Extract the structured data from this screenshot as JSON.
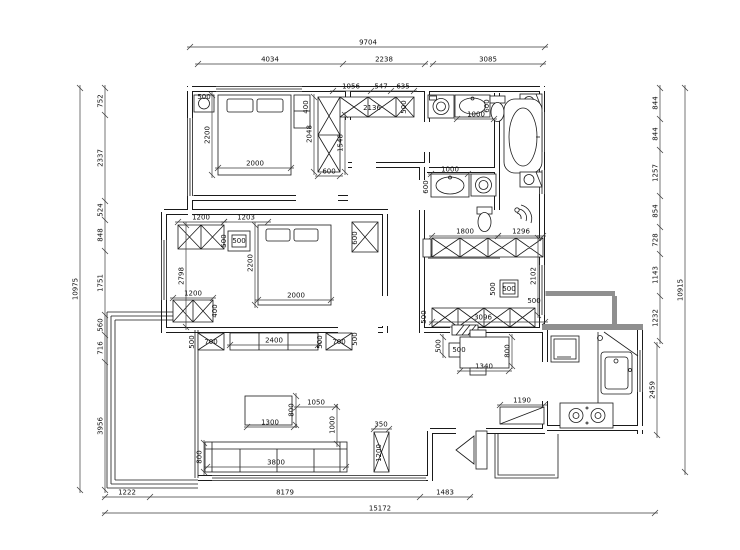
{
  "drawing": {
    "type": "apartment-floor-plan",
    "units": "mm"
  },
  "colors": {
    "line": "#1a1a1a",
    "gray_wall": "#8f8f8f",
    "background": "#ffffff",
    "dim_text": "#101010"
  },
  "dimensions": {
    "chains": [
      {
        "o": "h",
        "p": 47,
        "a": 190,
        "b": 545,
        "labels": [
          {
            "t": "9704",
            "at": 368
          }
        ]
      },
      {
        "o": "h",
        "p": 64,
        "a": 198,
        "b": 425,
        "ticks": [
          198,
          343,
          425
        ],
        "labels": [
          {
            "t": "4034",
            "at": 270
          },
          {
            "t": "2238",
            "at": 384
          }
        ]
      },
      {
        "o": "h",
        "p": 64,
        "a": 433,
        "b": 543,
        "labels": [
          {
            "t": "3085",
            "at": 488
          }
        ]
      },
      {
        "o": "h",
        "p": 91,
        "a": 333,
        "b": 414,
        "ticks": [
          333,
          371,
          391,
          414
        ],
        "labels": [
          {
            "t": "1056",
            "at": 351
          },
          {
            "t": "547",
            "at": 381
          },
          {
            "t": "635",
            "at": 403
          }
        ]
      },
      {
        "o": "v",
        "p": 80,
        "a": 88,
        "b": 490,
        "labels": [
          {
            "t": "10975",
            "at": 289
          }
        ]
      },
      {
        "o": "v",
        "p": 105,
        "a": 88,
        "b": 490,
        "ticks": [
          88,
          115,
          201,
          220,
          251,
          315,
          335,
          362,
          490
        ],
        "labels": [
          {
            "t": "752",
            "at": 101
          },
          {
            "t": "2337",
            "at": 158
          },
          {
            "t": "524",
            "at": 210
          },
          {
            "t": "848",
            "at": 235
          },
          {
            "t": "1751",
            "at": 283
          },
          {
            "t": "560",
            "at": 325
          },
          {
            "t": "716",
            "at": 348
          },
          {
            "t": "3956",
            "at": 426
          }
        ]
      },
      {
        "o": "v",
        "p": 660,
        "a": 88,
        "b": 341,
        "ticks": [
          88,
          119,
          150,
          196,
          227,
          254,
          296,
          341
        ],
        "labels": [
          {
            "t": "844",
            "at": 103
          },
          {
            "t": "844",
            "at": 134
          },
          {
            "t": "1257",
            "at": 173
          },
          {
            "t": "854",
            "at": 211
          },
          {
            "t": "728",
            "at": 240
          },
          {
            "t": "1143",
            "at": 275
          },
          {
            "t": "1232",
            "at": 318
          }
        ]
      },
      {
        "o": "v",
        "p": 657,
        "a": 345,
        "b": 435,
        "labels": [
          {
            "t": "2459",
            "at": 390
          }
        ]
      },
      {
        "o": "v",
        "p": 685,
        "a": 88,
        "b": 472,
        "labels": [
          {
            "t": "10915",
            "at": 290
          }
        ]
      },
      {
        "o": "h",
        "p": 497,
        "a": 105,
        "b": 470,
        "ticks": [
          105,
          150,
          420,
          470
        ],
        "labels": [
          {
            "t": "1222",
            "at": 127
          },
          {
            "t": "8179",
            "at": 285
          },
          {
            "t": "1483",
            "at": 445
          }
        ]
      },
      {
        "o": "h",
        "p": 513,
        "a": 105,
        "b": 655,
        "labels": [
          {
            "t": "15172",
            "at": 380
          }
        ]
      },
      {
        "o": "h",
        "p": 168,
        "a": 218,
        "b": 291,
        "labels": [
          {
            "t": "2000",
            "at": 255
          }
        ]
      },
      {
        "o": "v",
        "p": 212,
        "a": 95,
        "b": 175,
        "labels": [
          {
            "t": "2200",
            "at": 135
          }
        ]
      },
      {
        "o": "h",
        "p": 119,
        "a": 457,
        "b": 494,
        "labels": [
          {
            "t": "1000",
            "at": 476
          }
        ]
      },
      {
        "o": "h",
        "p": 174,
        "a": 431,
        "b": 468,
        "labels": [
          {
            "t": "1000",
            "at": 450
          }
        ]
      },
      {
        "o": "h",
        "p": 236,
        "a": 432,
        "b": 498,
        "labels": [
          {
            "t": "1800",
            "at": 465
          }
        ]
      },
      {
        "o": "h",
        "p": 236,
        "a": 498,
        "b": 543,
        "labels": [
          {
            "t": "1296",
            "at": 521
          }
        ]
      },
      {
        "o": "v",
        "p": 538,
        "a": 238,
        "b": 315,
        "labels": [
          {
            "t": "2102",
            "at": 276
          }
        ]
      },
      {
        "o": "h",
        "p": 322,
        "a": 432,
        "b": 545,
        "labels": [
          {
            "t": "3096",
            "at": 483
          }
        ]
      },
      {
        "o": "h",
        "p": 222,
        "a": 178,
        "b": 224,
        "labels": [
          {
            "t": "1200",
            "at": 201
          }
        ]
      },
      {
        "o": "h",
        "p": 222,
        "a": 224,
        "b": 268,
        "labels": [
          {
            "t": "1203",
            "at": 246
          }
        ]
      },
      {
        "o": "v",
        "p": 186,
        "a": 225,
        "b": 327,
        "labels": [
          {
            "t": "2798",
            "at": 276
          }
        ]
      },
      {
        "o": "h",
        "p": 298,
        "a": 173,
        "b": 213,
        "labels": [
          {
            "t": "1200",
            "at": 193
          }
        ]
      },
      {
        "o": "v",
        "p": 255,
        "a": 225,
        "b": 305,
        "labels": [
          {
            "t": "2200",
            "at": 263
          }
        ]
      },
      {
        "o": "h",
        "p": 300,
        "a": 258,
        "b": 331,
        "labels": [
          {
            "t": "2000",
            "at": 296
          }
        ]
      },
      {
        "o": "h",
        "p": 345,
        "a": 230,
        "b": 318,
        "labels": [
          {
            "t": "2400",
            "at": 274
          }
        ]
      },
      {
        "o": "h",
        "p": 427,
        "a": 247,
        "b": 294,
        "labels": [
          {
            "t": "1300",
            "at": 270
          }
        ]
      },
      {
        "o": "v",
        "p": 296,
        "a": 396,
        "b": 425,
        "labels": [
          {
            "t": "800",
            "at": 410
          }
        ]
      },
      {
        "o": "h",
        "p": 407,
        "a": 297,
        "b": 335,
        "labels": [
          {
            "t": "1050",
            "at": 316
          }
        ]
      },
      {
        "o": "v",
        "p": 337,
        "a": 407,
        "b": 444,
        "labels": [
          {
            "t": "1000",
            "at": 425
          }
        ]
      },
      {
        "o": "v",
        "p": 204,
        "a": 443,
        "b": 472,
        "labels": [
          {
            "t": "800",
            "at": 457
          }
        ]
      },
      {
        "o": "h",
        "p": 467,
        "a": 207,
        "b": 346,
        "labels": [
          {
            "t": "3800",
            "at": 276
          }
        ]
      },
      {
        "o": "h",
        "p": 429,
        "a": 374,
        "b": 389,
        "labels": [
          {
            "t": "350",
            "at": 381
          }
        ]
      },
      {
        "o": "h",
        "p": 371,
        "a": 460,
        "b": 509,
        "labels": [
          {
            "t": "1340",
            "at": 484
          }
        ]
      },
      {
        "o": "v",
        "p": 512,
        "a": 337,
        "b": 366,
        "labels": [
          {
            "t": "800",
            "at": 351
          }
        ]
      },
      {
        "o": "v",
        "p": 443,
        "a": 337,
        "b": 355,
        "labels": [
          {
            "t": "500",
            "at": 346
          }
        ]
      },
      {
        "o": "h",
        "p": 405,
        "a": 500,
        "b": 544,
        "labels": [
          {
            "t": "1190",
            "at": 522
          }
        ]
      },
      {
        "o": "v",
        "p": 314,
        "a": 97,
        "b": 172,
        "labels": [
          {
            "t": "2048",
            "at": 134
          }
        ]
      },
      {
        "o": "v",
        "p": 345,
        "a": 115,
        "b": 172,
        "labels": [
          {
            "t": "1548",
            "at": 143
          }
        ]
      },
      {
        "o": "h",
        "p": 176,
        "a": 318,
        "b": 340,
        "labels": [
          {
            "t": "600",
            "at": 329
          }
        ]
      }
    ],
    "free_labels": [
      {
        "t": "500",
        "x": 204,
        "y": 99
      },
      {
        "t": "400",
        "x": 308,
        "y": 107,
        "r": -90
      },
      {
        "t": "2136",
        "x": 372,
        "y": 110
      },
      {
        "t": "500",
        "x": 406,
        "y": 107,
        "r": -90
      },
      {
        "t": "600",
        "x": 489,
        "y": 106,
        "r": -90
      },
      {
        "t": "600",
        "x": 428,
        "y": 187,
        "r": -90
      },
      {
        "t": "500",
        "x": 226,
        "y": 241,
        "r": -90
      },
      {
        "t": "500",
        "x": 239,
        "y": 243
      },
      {
        "t": "600",
        "x": 357,
        "y": 238,
        "r": -90
      },
      {
        "t": "400",
        "x": 217,
        "y": 311,
        "r": -90
      },
      {
        "t": "500",
        "x": 194,
        "y": 342,
        "r": -90
      },
      {
        "t": "700",
        "x": 211,
        "y": 344
      },
      {
        "t": "500",
        "x": 322,
        "y": 342,
        "r": -90
      },
      {
        "t": "700",
        "x": 339,
        "y": 344
      },
      {
        "t": "500",
        "x": 357,
        "y": 339,
        "r": -90
      },
      {
        "t": "500",
        "x": 495,
        "y": 289,
        "r": -90
      },
      {
        "t": "500",
        "x": 509,
        "y": 291
      },
      {
        "t": "500",
        "x": 534,
        "y": 303
      },
      {
        "t": "500",
        "x": 426,
        "y": 317,
        "r": -90
      },
      {
        "t": "1200",
        "x": 381,
        "y": 453,
        "r": -90
      },
      {
        "t": "500",
        "x": 459,
        "y": 352
      }
    ]
  }
}
